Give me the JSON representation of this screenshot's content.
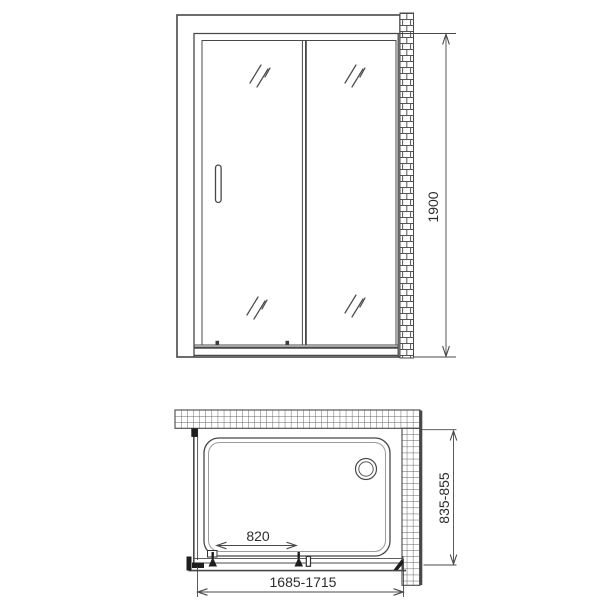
{
  "drawing": {
    "type": "shower-enclosure-technical-drawing",
    "line_color": "#484848",
    "text_color": "#2d2d2d",
    "hardware_color": "#1e1e1e"
  },
  "front_view": {
    "height_label": "1900"
  },
  "plan_view": {
    "door_opening_label": "820",
    "width_range_label": "1685-1715",
    "depth_range_label": "835-855"
  }
}
